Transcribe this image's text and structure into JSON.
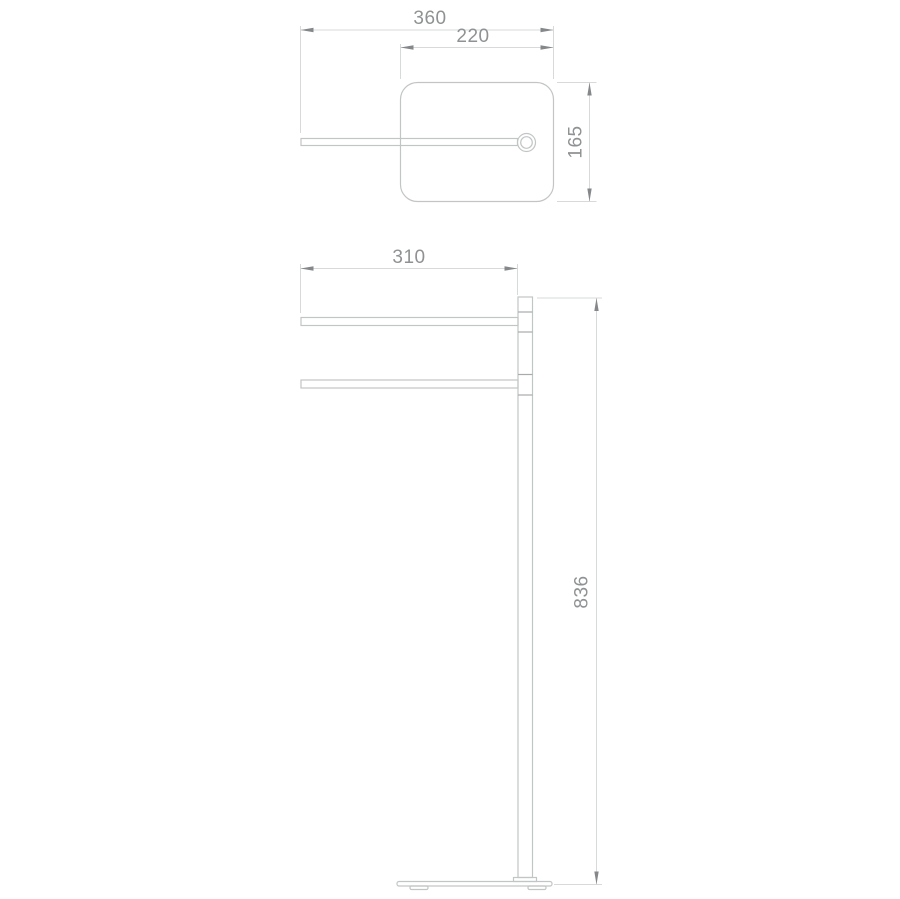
{
  "document": {
    "background": "#ffffff"
  },
  "views": {
    "top": {
      "dims": {
        "overall_reach": "360",
        "base_width": "220",
        "base_depth": "165"
      }
    },
    "front": {
      "dims": {
        "rail_length": "310",
        "overall_height": "836"
      }
    }
  },
  "colors": {
    "geometry_line": "#c2c5c6",
    "dimension_line": "#d7d9da",
    "arrow": "#85888a",
    "text": "#8f9294"
  }
}
